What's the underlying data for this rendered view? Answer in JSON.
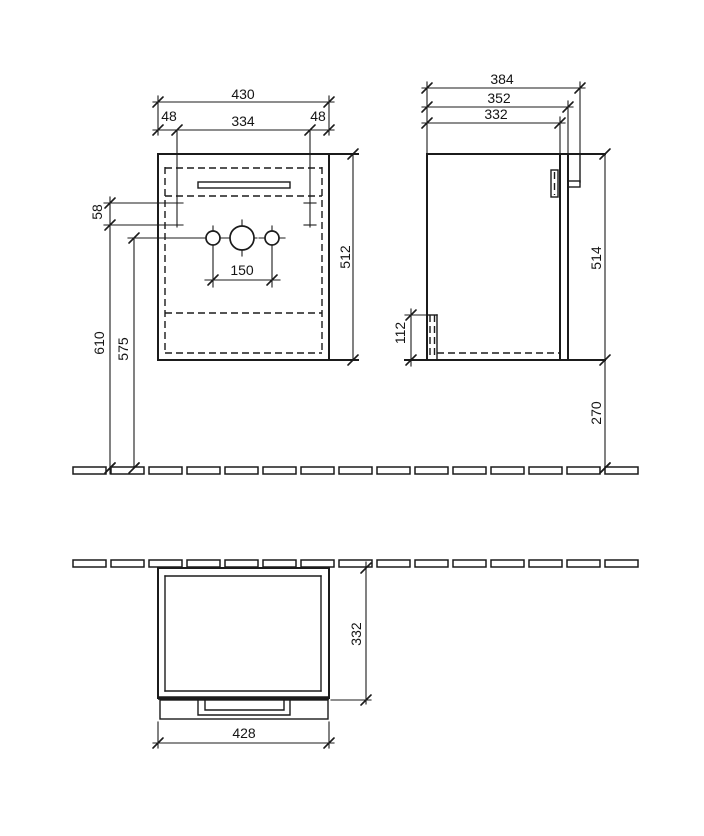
{
  "front_view": {
    "overall_width": "430",
    "left_offset": "48",
    "inner_width": "334",
    "right_offset": "48",
    "bracket_offset": "58",
    "tap_hole_spacing": "150",
    "height": "512",
    "bracket_height": "610",
    "tap_hole_height": "575"
  },
  "side_view": {
    "overall_depth": "384",
    "depth_with_front": "352",
    "carcass_depth": "332",
    "height": "514",
    "recess_height": "112",
    "floor_clearance": "270"
  },
  "top_view": {
    "depth": "332",
    "front_width": "428"
  }
}
